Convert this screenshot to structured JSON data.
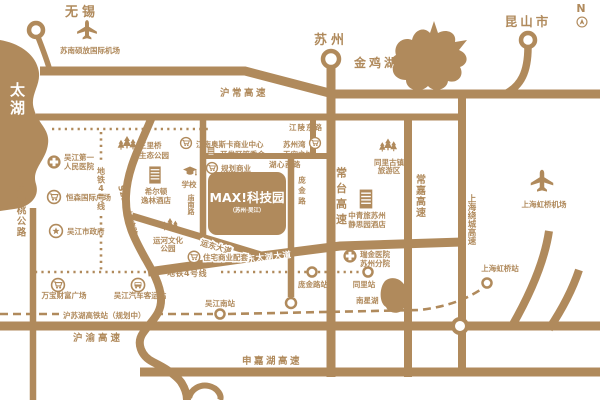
{
  "labels": {
    "compass": "N",
    "wuxi": "无锡",
    "suzhou": "苏州",
    "kunshan": "昆山市",
    "taihu": "太湖",
    "jinjihu": "金鸡湖",
    "nanxinghu": "南星湖",
    "sunan_airport": "苏南硕放国际机场",
    "hongqiao_airport": "上海虹桥机场",
    "huchang": "沪常高速",
    "changtai": "常台高速",
    "changjia": "常嘉高速",
    "raocheng": "上海绕城高速",
    "huyu": "沪渝高速",
    "shenjiahu": "申嘉湖高速",
    "s227": "S227 快速路",
    "suzhentao": "苏震桃公路",
    "jiangling": "江陵东路",
    "huxin": "湖心西路",
    "miaonan": "庙南路",
    "pangjin": "庞金路",
    "yundong": "运东大道",
    "dongtaihu": "东太湖大道",
    "metro4": "地铁4号线",
    "hsr": "沪苏湖高铁站（规划中）",
    "wujiangnan": "吴江南站",
    "pangjin_st": "庞金路站",
    "tongli_st": "同里站",
    "hongqiao_st": "上海虹桥站"
  },
  "pois": {
    "hospital_l1": "吴江第一",
    "hospital_l2": "人民医院",
    "hengsen": "恒森国际广场",
    "government": "吴江市政府",
    "sanliqiao_l1": "三里桥",
    "sanliqiao_l2": "生态公园",
    "hilton_l1": "希尔顿",
    "hilton_l2": "逸林酒店",
    "school": "学校",
    "aosika": "江南奥斯卡商业中心",
    "kaifaqu": "开发区管委会",
    "guihua": "规划商业",
    "skycity_l1": "苏州湾",
    "skycity_l2": "天空之城",
    "yunhe_l1": "运河文化",
    "yunhe_l2": "公园",
    "zhuzhai": "住宅商业配套",
    "tongli_l1": "同里古镇",
    "tongli_l2": "旅游区",
    "cyts_l1": "中青旅苏州",
    "cyts_l2": "静思园酒店",
    "ruijin_l1": "瑞金医院",
    "ruijin_l2": "苏州分院",
    "wanbao": "万宝财富广场",
    "keyun": "吴江汽车客运站"
  },
  "project": {
    "logo": "MAX!科技园",
    "sub": "（苏州·吴江）"
  },
  "colors": {
    "brand": "#b08a5c",
    "background": "#ffffff"
  }
}
